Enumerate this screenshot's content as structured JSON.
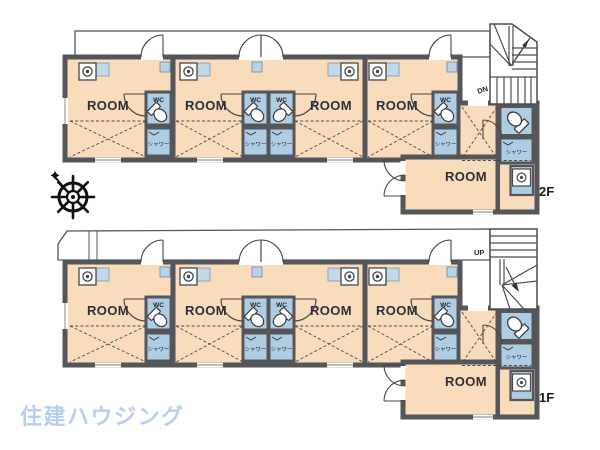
{
  "plan": {
    "labels": {
      "room": "ROOM",
      "wc": "WC",
      "shower": "シャワー"
    },
    "floors": [
      {
        "id": "2F",
        "stair_label": "DN",
        "room_count": 5
      },
      {
        "id": "1F",
        "stair_label": "UP",
        "room_count": 5
      }
    ]
  },
  "logo": {
    "text": "住建ハウジング",
    "color": "#b9cdf1"
  },
  "icons": {
    "compass": "ship-wheel-compass",
    "stove": "stove-burner",
    "toilet": "toilet-plan",
    "washer": "washing-machine"
  },
  "colors": {
    "room_fill": "#f8dcbc",
    "wet_area_fill": "#aecde3",
    "window_fill": "#c3d9ea",
    "wall": "#55565a",
    "text": "#26262e"
  }
}
